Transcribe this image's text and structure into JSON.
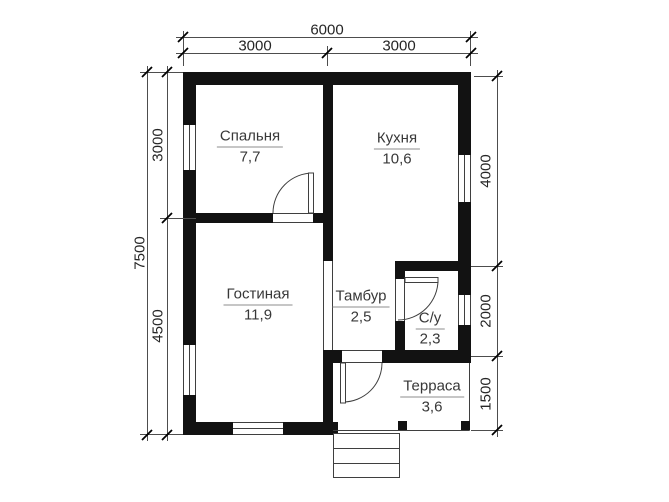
{
  "plan": {
    "rooms": [
      {
        "id": "bedroom",
        "name": "Спальня",
        "area": "7,7"
      },
      {
        "id": "kitchen",
        "name": "Кухня",
        "area": "10,6"
      },
      {
        "id": "living",
        "name": "Гостиная",
        "area": "11,9"
      },
      {
        "id": "tambour",
        "name": "Тамбур",
        "area": "2,5"
      },
      {
        "id": "bathroom",
        "name": "С/у",
        "area": "2,3"
      },
      {
        "id": "terrace",
        "name": "Терраса",
        "area": "3,6"
      }
    ],
    "dimensions": {
      "top": {
        "total": "6000",
        "segments": [
          "3000",
          "3000"
        ]
      },
      "left": {
        "total": "7500",
        "segments": [
          "3000",
          "4500"
        ]
      },
      "right": {
        "segments": [
          "4000",
          "2000",
          "1500"
        ]
      }
    },
    "colors": {
      "wall": "#121212",
      "thin": "#3f3f3f",
      "dim": "#4d4d4d",
      "text": "#383838",
      "underline": "#8c8c8c",
      "background": "#ffffff"
    }
  }
}
